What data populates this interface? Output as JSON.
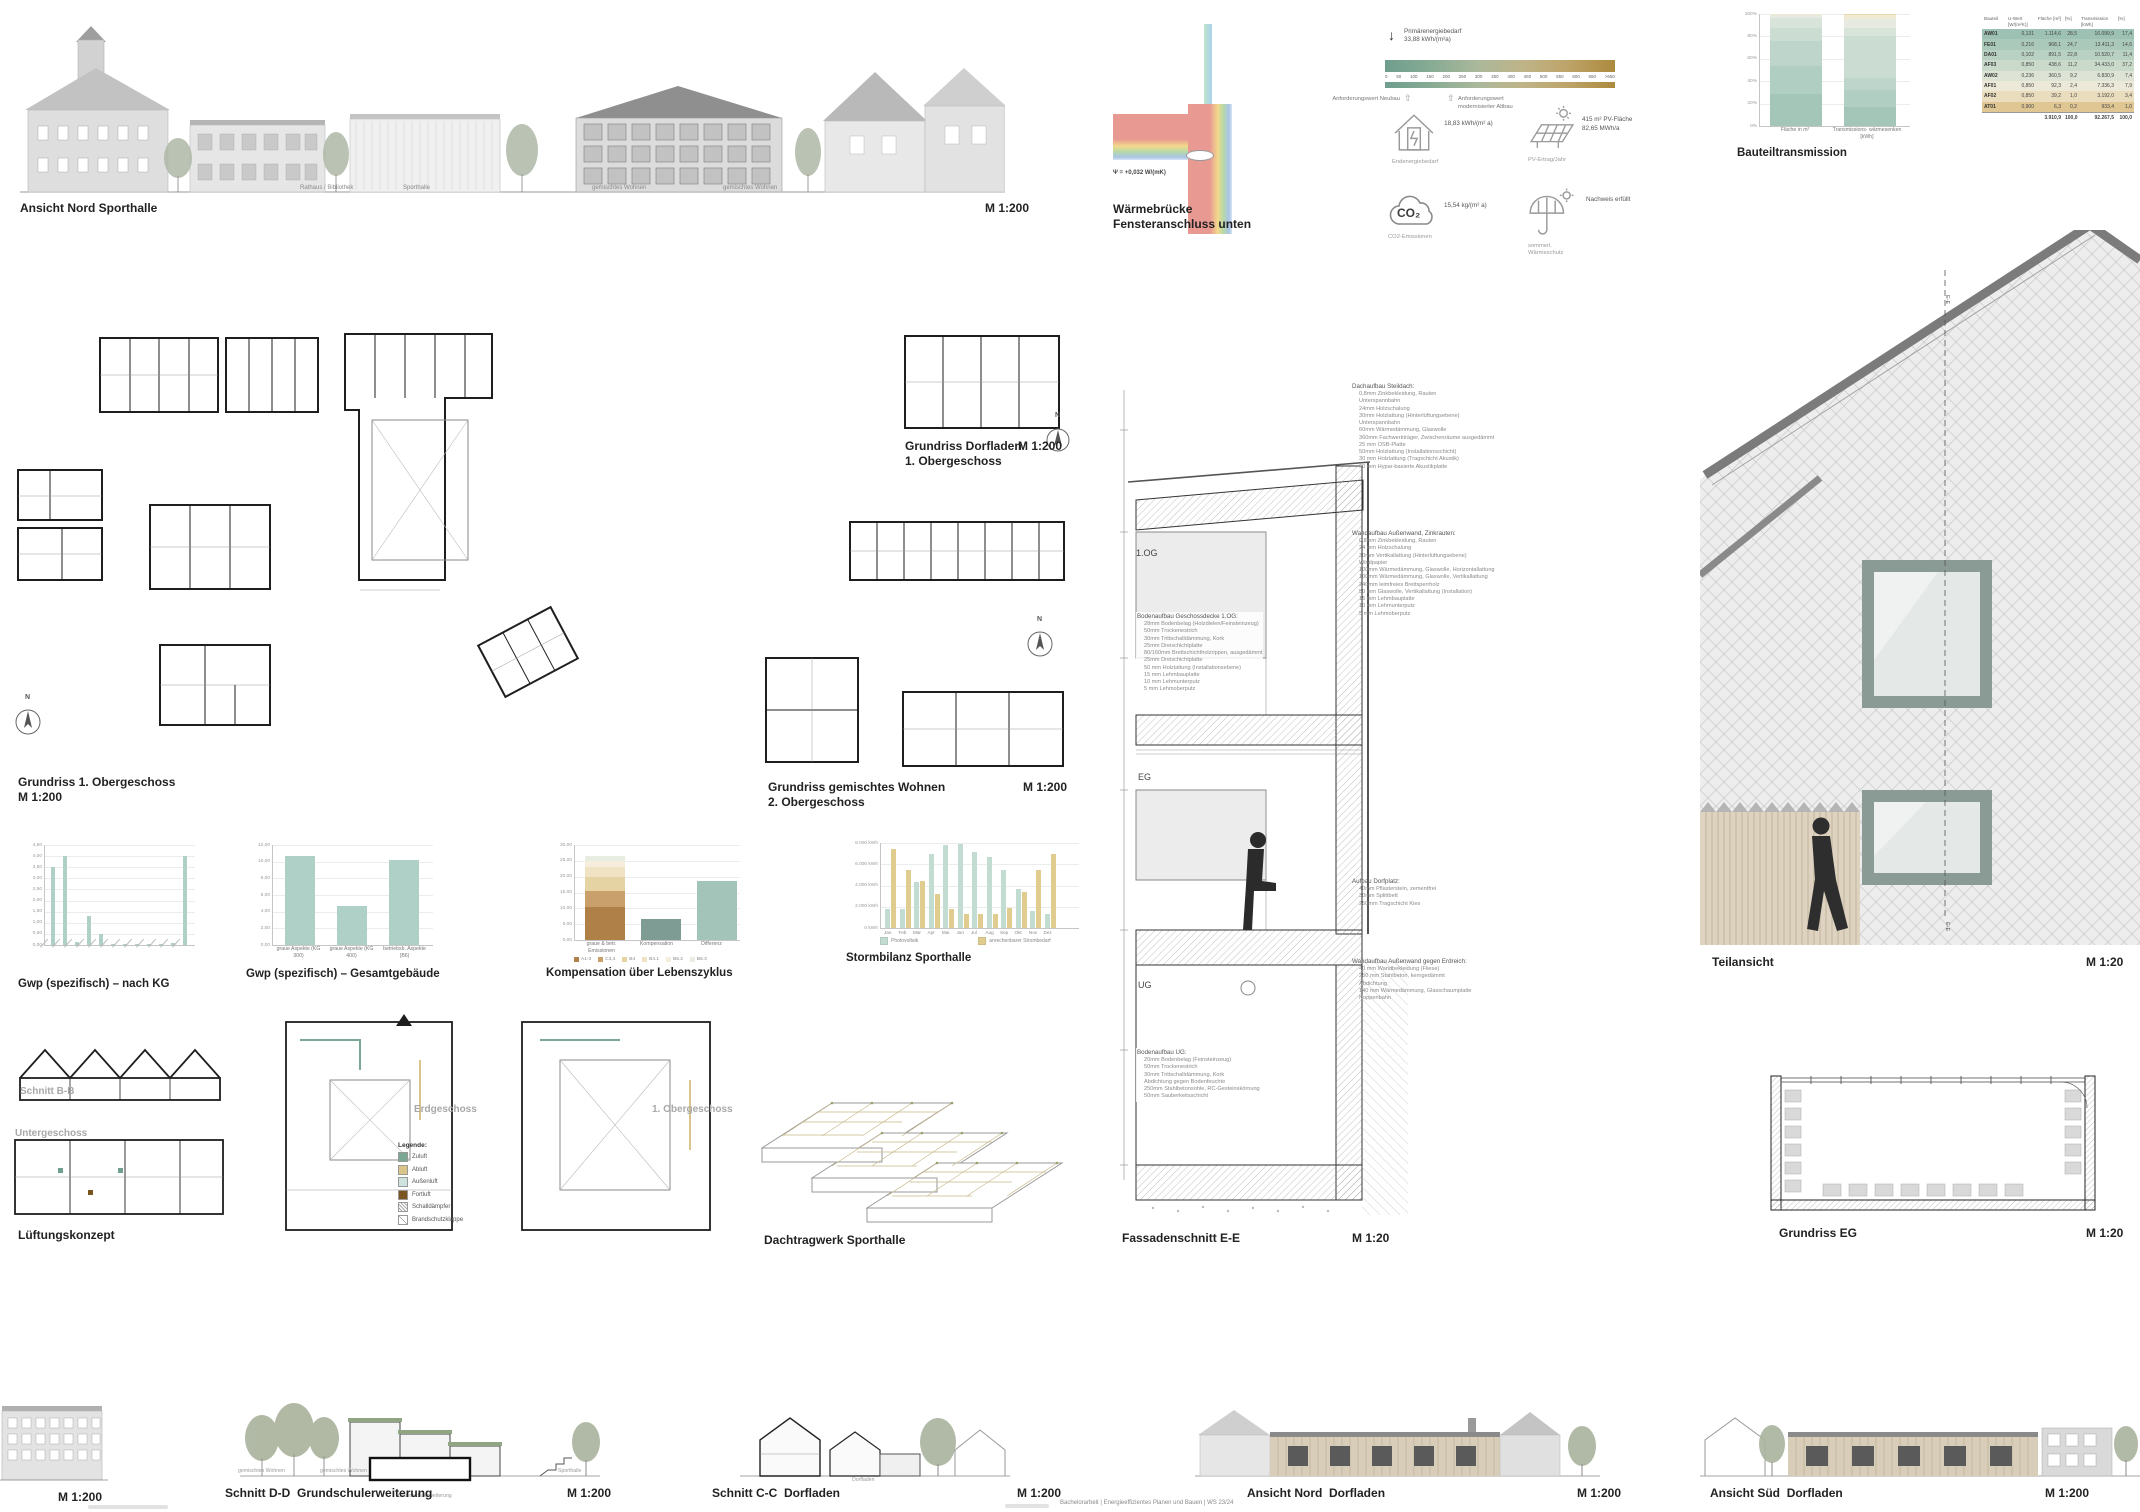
{
  "top": {
    "elevation": {
      "title": "Ansicht Nord Sporthalle",
      "scale": "M 1:200",
      "building_labels": [
        "Rathaus / Bibliothek",
        "Sporthalle",
        "gemischtes Wohnen",
        "gemischtes Wohnen"
      ]
    },
    "waermebruecke": {
      "title1": "Wärmebrücke",
      "title2": "Fensteranschluss unten",
      "psi": "Ψ = +0,032 W/(mK)"
    },
    "scale_bar": {
      "label1": "Primärenergiebedarf",
      "label2": "33,88 kWh/(m²a)",
      "ticks": [
        "0",
        "50",
        "100",
        "150",
        "200",
        "250",
        "300",
        "350",
        "400",
        "450",
        "500",
        "550",
        "600",
        "650",
        ">650"
      ],
      "req1": "Anforderungswert Neubau",
      "req2": "Anforderungswert modernisierter Altbau"
    },
    "kpis": [
      {
        "icon": "energy-house-icon",
        "value": "18,83 kWh/(m² a)",
        "value2": "",
        "label": "Endenergiebedarf"
      },
      {
        "icon": "pv-panel-icon",
        "value": "415 m² PV-Fläche",
        "value2": "82,65 MWh/a",
        "label": "PV-Ertrag/Jahr"
      },
      {
        "icon": "co2-cloud-icon",
        "value": "15,54 kg/(m² a)",
        "value2": "",
        "label": "CO2-Emissionen",
        "icon_text": "CO₂"
      },
      {
        "icon": "umbrella-sun-icon",
        "value": "Nachweis erfüllt",
        "value2": "",
        "label": "sommerl. Wärmeschutz"
      }
    ]
  },
  "table": {
    "headers": [
      "Bauteil",
      "U-Wert [W/(m²K)]",
      "Fläche [m²]",
      "[%]",
      "Transmission [kWh]",
      "[%]"
    ],
    "rows": [
      {
        "c": [
          "AW01",
          "0,131",
          "1.114,6",
          "28,5",
          "16.099,9",
          "17,4"
        ],
        "color": "#9dc2b3"
      },
      {
        "c": [
          "FE01",
          "0,216",
          "968,1",
          "24,7",
          "13.411,3",
          "14,6"
        ],
        "color": "#abc9ba"
      },
      {
        "c": [
          "DA01",
          "0,102",
          "891,5",
          "22,8",
          "10.520,7",
          "11,4"
        ],
        "color": "#b9d1c2"
      },
      {
        "c": [
          "AF03",
          "0,850",
          "438,6",
          "11,2",
          "34.433,0",
          "37,2"
        ],
        "color": "#c9dacb"
      },
      {
        "c": [
          "AW02",
          "0,236",
          "360,5",
          "9,2",
          "6.830,9",
          "7,4"
        ],
        "color": "#dde4d6"
      },
      {
        "c": [
          "AF01",
          "0,850",
          "92,3",
          "2,4",
          "7.336,3",
          "7,9"
        ],
        "color": "#ece9d8"
      },
      {
        "c": [
          "AF02",
          "0,850",
          "39,2",
          "1,0",
          "3.192,0",
          "3,4"
        ],
        "color": "#e9ddbd"
      },
      {
        "c": [
          "AT01",
          "0,900",
          "6,3",
          "0,2",
          "933,4",
          "1,0"
        ],
        "color": "#dfc693"
      }
    ],
    "total": [
      "",
      "",
      "3.910,9",
      "100,0",
      "92.267,5",
      "100,0"
    ]
  },
  "plans": {
    "north": "N",
    "og1": {
      "title": "Grundriss 1. Obergeschoss",
      "scale": "M 1:200"
    },
    "dorfladen": {
      "title": "Grundriss Dorfladen",
      "subtitle": "1. Obergeschoss",
      "scale": "M 1:200"
    },
    "wohnen": {
      "title": "Grundriss gemischtes Wohnen",
      "subtitle": "2. Obergeschoss",
      "scale": "M 1:200"
    }
  },
  "chart_data": [
    {
      "id": "gwp_kg",
      "type": "bar",
      "title": "Gwp (spezifisch) – nach KG",
      "ylim": [
        0,
        4.5
      ],
      "ytick_step": 0.5,
      "bar_color": "#aed0c6",
      "categories": [
        "",
        "",
        "",
        "",
        "",
        "",
        "",
        "",
        "",
        "",
        "",
        ""
      ],
      "values": [
        3.5,
        4.0,
        0.15,
        1.3,
        0.5,
        0.05,
        0.05,
        0.05,
        0.05,
        0.05,
        0.1,
        4.0
      ]
    },
    {
      "id": "gwp_total",
      "type": "bar",
      "title": "Gwp (spezifisch) – Gesamtgebäude",
      "ylim": [
        0,
        12
      ],
      "ytick_step": 2,
      "bar_color": "#aed0c6",
      "categories": [
        "graue Aspekte (KG 300)",
        "graue Aspekte (KG 400)",
        "betriebsb. Aspekte (B6)"
      ],
      "values": [
        10.7,
        4.7,
        10.2
      ]
    },
    {
      "id": "kompensation",
      "type": "stacked-bar",
      "title": "Kompensation über Lebenszyklus",
      "ylim": [
        0,
        30
      ],
      "ytick_step": 5,
      "categories": [
        "graue & betr. Emissionen",
        "Kompensation",
        "Differenz"
      ],
      "stack": [
        {
          "name": "A1-3",
          "value": 10.5,
          "color": "#b08049"
        },
        {
          "name": "C3,4",
          "value": 5.0,
          "color": "#c9a06b"
        },
        {
          "name": "B4",
          "value": 4.5,
          "color": "#e6d3a3"
        },
        {
          "name": "B4.1",
          "value": 3.0,
          "color": "#efe3c3"
        },
        {
          "name": "B6.2",
          "value": 2.0,
          "color": "#f5eedd"
        },
        {
          "name": "B6.3",
          "value": 1.5,
          "color": "#e8ede2"
        }
      ],
      "single_bars": [
        {
          "name": "Kompensation",
          "value": 6.5,
          "color": "#7e9c94"
        },
        {
          "name": "Differenz",
          "value": 18.5,
          "color": "#a3c4b8"
        }
      ]
    },
    {
      "id": "strombilanz",
      "type": "grouped-bar",
      "title": "Stormbilanz Sporthalle",
      "ylim": [
        0,
        8000
      ],
      "yticks": [
        "0 kWh",
        "2.000 kWh",
        "4.000 kWh",
        "6.000 kWh",
        "8.000 kWh"
      ],
      "categories": [
        "Jan",
        "Feb",
        "Mär",
        "Apr",
        "Mai",
        "Jun",
        "Jul",
        "Aug",
        "Sep",
        "Okt",
        "Nov",
        "Dez"
      ],
      "series": [
        {
          "name": "Photovoltaik",
          "color": "#c2dcd2",
          "values": [
            1800,
            1800,
            4300,
            7000,
            7800,
            7900,
            7200,
            6700,
            5500,
            3700,
            1600,
            1300
          ]
        },
        {
          "name": "anrechenbarer Strombedarf",
          "color": "#e0cc8e",
          "values": [
            7400,
            5500,
            4400,
            3200,
            1800,
            1300,
            1300,
            1300,
            1900,
            3400,
            5500,
            7000
          ]
        }
      ]
    },
    {
      "id": "bauteiltransmission",
      "type": "stacked-bar",
      "title": "Bauteiltransmission",
      "yticks": [
        "0%",
        "20%",
        "40%",
        "60%",
        "80%",
        "100%"
      ],
      "categories": [
        "Fläche in m²",
        "Transmissions- wärmesenken [kWh]"
      ],
      "components": [
        {
          "name": "AW01",
          "color": "#a3c6b8",
          "flaeche_pct": 28.5,
          "transmission_pct": 17.4
        },
        {
          "name": "FE01",
          "color": "#b0cec1",
          "flaeche_pct": 24.7,
          "transmission_pct": 14.6
        },
        {
          "name": "DA01",
          "color": "#bdd5ca",
          "flaeche_pct": 22.8,
          "transmission_pct": 11.4
        },
        {
          "name": "AF03",
          "color": "#cbdcd2",
          "flaeche_pct": 11.2,
          "transmission_pct": 37.2
        },
        {
          "name": "AW02",
          "color": "#d8e3da",
          "flaeche_pct": 9.2,
          "transmission_pct": 7.4
        },
        {
          "name": "AF01",
          "color": "#e6eae1",
          "flaeche_pct": 2.4,
          "transmission_pct": 7.9
        },
        {
          "name": "AF02",
          "color": "#f0ead3",
          "flaeche_pct": 1.0,
          "transmission_pct": 3.4
        },
        {
          "name": "AT01",
          "color": "#ead9ae",
          "flaeche_pct": 0.2,
          "transmission_pct": 1.0
        }
      ]
    }
  ],
  "lueftung": {
    "schnitt": "Schnitt B-B",
    "ug": "Untergeschoss",
    "eg": "Erdgeschoss",
    "og": "1. Obergeschoss",
    "title": "Lüftungskonzept",
    "legende_title": "Legende:",
    "legende": [
      {
        "label": "Zuluft",
        "color": "#7aa893",
        "swatch": "fill"
      },
      {
        "label": "Abluft",
        "color": "#d9c48a",
        "swatch": "fill"
      },
      {
        "label": "Außenluft",
        "color": "#cfe3de",
        "swatch": "fill"
      },
      {
        "label": "Fortluft",
        "color": "#7a5520",
        "swatch": "fill"
      },
      {
        "label": "Schalldämpfer",
        "color": "#ffffff",
        "swatch": "hatch"
      },
      {
        "label": "Brandschutzklappe",
        "color": "#ffffff",
        "swatch": "flap"
      }
    ]
  },
  "dachtragwerk": {
    "title": "Dachtragwerk Sporthalle"
  },
  "fassadenschnitt": {
    "title": "Fassadenschnitt E-E",
    "scale": "M 1:20",
    "floors": [
      "1.OG",
      "EG",
      "UG"
    ],
    "annotations": [
      {
        "title": "Dachaufbau Steildach:",
        "lines": [
          "0,8mm Zinkbekleidung, Rauten",
          "Unterspannbahn",
          "24mm Holzschalung",
          "30mm Holzlattung (Hinterlüftungsebene)",
          "Unterspannbahn",
          "60mm Wärmedämmung, Glaswolle",
          "360mm Fachwerkträger, Zwischenräume ausgedämmt",
          "25 mm OSB-Platte",
          "50mm Holzlattung (Installationsschicht)",
          "30 mm Holzlattung (Tragschicht Akustik)",
          "60 mm Hypar-basierte Akustikplatte"
        ]
      },
      {
        "title": "Wandaufbau Außenwand, Zinkrauten:",
        "lines": [
          "0,8mm Zinkbekleidung, Rauten",
          "24 mm Holzschalung",
          "30mm Vertikallattung (Hinterlüftungsebene)",
          "Windpapier",
          "100mm Wärmedämmung, Glaswolle, Horizontallattung",
          "100mm Wärmedämmung, Glaswolle, Vertikallattung",
          "240mm leimfreies Brettsperrholz",
          "50 mm Glaswolle, Vertikallattung (Installation)",
          "15 mm Lehmbauplatte",
          "10 mm Lehmunterputz",
          "5 mm Lehmoberputz"
        ]
      },
      {
        "title": "Bodenaufbau Geschossdecke 1.OG:",
        "lines": [
          "28mm Bodenbelag (Holzdielen/Feinsteinzeug)",
          "50mm Trockenestrich",
          "30mm Trittschalldämmung, Kork",
          "25mm Dreischichtplatte",
          "80/160mm Brettschichtholzrippen, ausgedämmt",
          "25mm Dreischichtplatte",
          "50 mm Holzlattung (Installationsebene)",
          "15 mm Lehmbauplatte",
          "10 mm Lehmunterputz",
          "5 mm Lehmoberputz"
        ]
      },
      {
        "title": "Aufbau Dorfplatz:",
        "lines": [
          "40mm Pflasterstein, zementfrei",
          "30mm Splittbett",
          "250mm Tragschicht Kies"
        ]
      },
      {
        "title": "Wandaufbau Außenwand gegen Erdreich:",
        "lines": [
          "40 mm Wandbekleidung (Fliese)",
          "250 mm Stahlbeton, kerngedämmt",
          "Abdichtung",
          "140 mm Wärmedämmung, Glasschaumplatte",
          "Noppenbahn"
        ]
      },
      {
        "title": "Bodenaufbau UG:",
        "lines": [
          "20mm Bodenbelag (Feinsteinzeug)",
          "50mm Trockenestrich",
          "30mm Trittschalldämmung, Kork",
          "Abdichtung gegen Bodenfeuchte",
          "250mm Stahlbetonsohle, RC-Gesteinskörnung",
          "50mm Sauberkeitsschicht"
        ]
      }
    ]
  },
  "teilansicht": {
    "title": "Teilansicht",
    "scale": "M 1:20",
    "marker": "E-E"
  },
  "grundriss_eg": {
    "title": "Grundriss EG",
    "scale": "M 1:20"
  },
  "bottom": {
    "left_scale": "M 1:200",
    "schnitt_dd": {
      "title": "Schnitt D-D",
      "subtitle": "Grundschulerweiterung",
      "scale": "M 1:200",
      "minis": [
        "gemischtes Wohnen",
        "gemischtes Wohnen",
        "Grundschulerweiterung",
        "Sporthalle"
      ]
    },
    "schnitt_cc": {
      "title": "Schnitt C-C",
      "subtitle": "Dorfladen",
      "scale": "M 1:200",
      "mini": "Dorfladen"
    },
    "ansicht_nord": {
      "title": "Ansicht Nord",
      "subtitle": "Dorfladen",
      "scale": "M 1:200"
    },
    "ansicht_sued": {
      "title": "Ansicht Süd",
      "subtitle": "Dorfladen",
      "scale": "M 1:200"
    }
  },
  "footer": {
    "credit": "Bachelorarbeit | Energieeffizientes Planen und Bauen | WS 23/24"
  }
}
